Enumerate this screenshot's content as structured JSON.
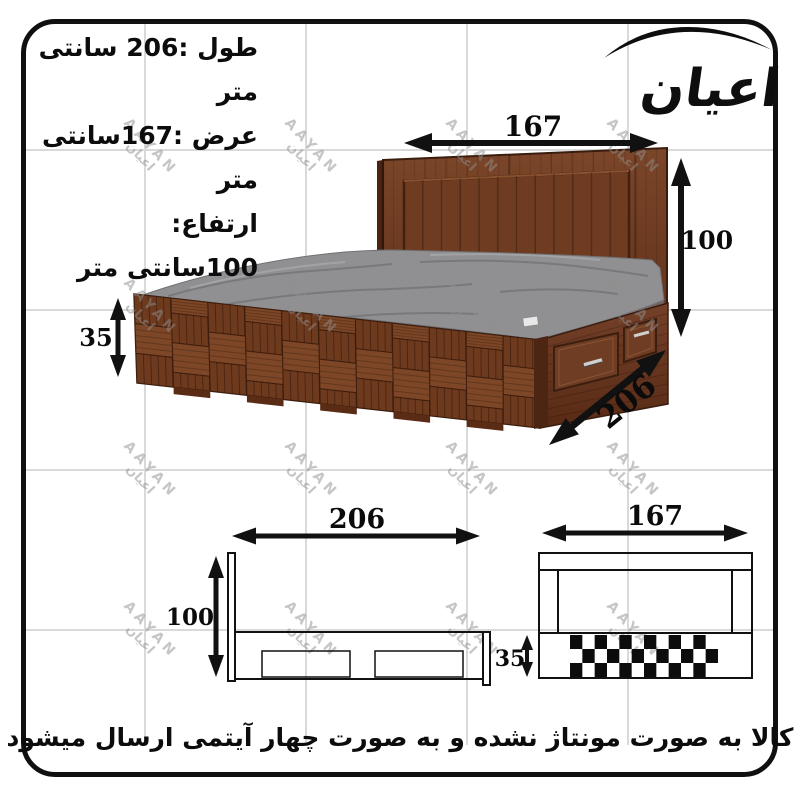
{
  "brand": {
    "logo_text": "اعیان",
    "watermark_latin": "AAYAN",
    "watermark_persian": "اعیان"
  },
  "specs": {
    "length": "طول :206 سانتی متر",
    "width": "عرض :167سانتی  متر",
    "height": "ارتفاع: 100سانتی متر"
  },
  "photo": {
    "dims": {
      "width": "167",
      "height": "100",
      "base_height": "35",
      "length": "206"
    }
  },
  "views": {
    "side": {
      "length": "206",
      "height": "100"
    },
    "front": {
      "width": "167",
      "base_height": "35",
      "checker_rows": 3,
      "checker_cols": 12
    }
  },
  "footer": {
    "note": "کالا به صورت مونتاژ نشده و به صورت چهار آیتمی ارسال میشود"
  },
  "colors": {
    "line": "#111111",
    "grid": "#d9d9d9",
    "wood_dark": "#5e2f1a",
    "wood_mid": "#6e3a1e",
    "wood_light": "#7c4627",
    "mattress": "#909092"
  }
}
